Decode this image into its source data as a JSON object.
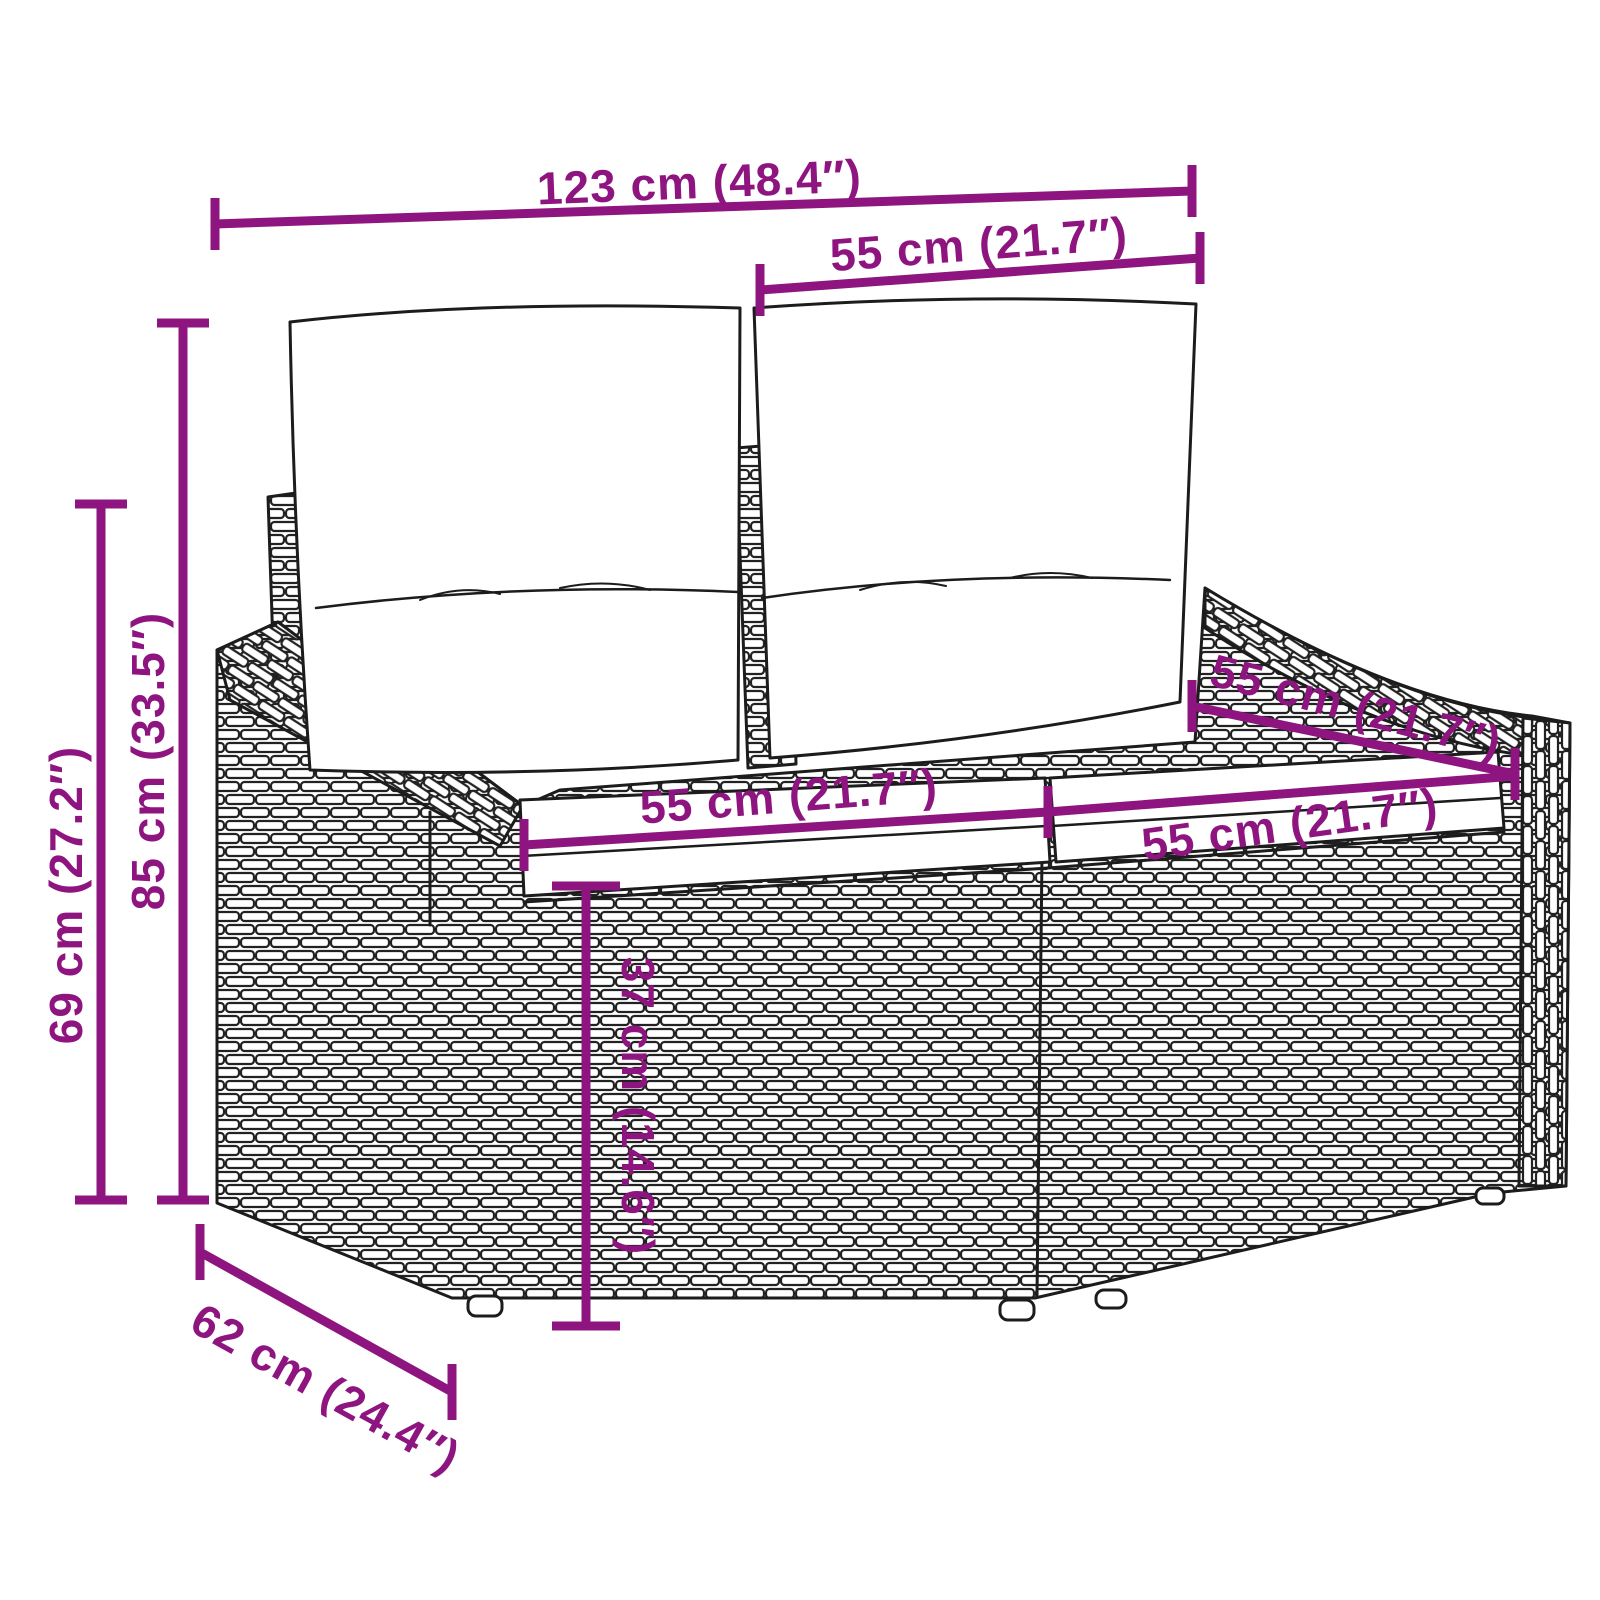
{
  "figure": {
    "background": "#ffffff",
    "accent_color": "#8e157f",
    "line_color": "#1c1c1c",
    "dimensions": {
      "overall_width": "123 cm (48.4″)",
      "backrest_width": "55 cm (21.7″)",
      "total_height": "85 cm (33.5″)",
      "armrest_height": "69 cm (27.2″)",
      "seat_depth": "55 cm (21.7″)",
      "seat_width_left": "55 cm (21.7″)",
      "seat_width_right": "55 cm (21.7″)",
      "seat_height": "37 cm (14.6″)",
      "overall_depth": "62 cm (24.4″)"
    }
  }
}
